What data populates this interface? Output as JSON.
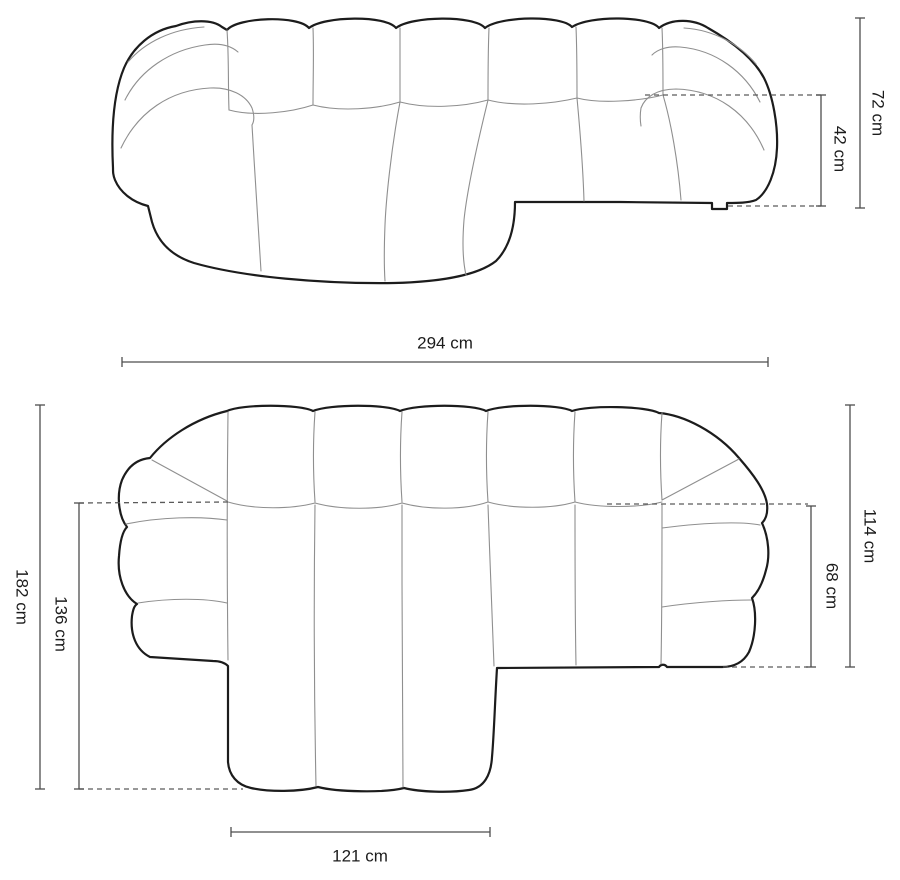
{
  "diagram": {
    "subject": "corner-sofa-dimension-drawing",
    "views": {
      "front_view": "front perspective view",
      "plan_view": "top plan view"
    },
    "labels": {
      "front_height": "72 cm",
      "front_seat_height": "42 cm",
      "plan_width": "294 cm",
      "plan_total_depth": "182 cm",
      "plan_chaise_inner_depth": "136 cm",
      "plan_side_depth": "114 cm",
      "plan_seat_depth": "68 cm",
      "plan_chaise_width": "121 cm"
    },
    "colors": {
      "background": "#ffffff",
      "outline": "#1c1c1c",
      "seam": "#8f8f8f",
      "dimension_line": "#4d4d4d",
      "dashed_line": "#5a5a5a",
      "label_text": "#1c1c1c"
    }
  }
}
